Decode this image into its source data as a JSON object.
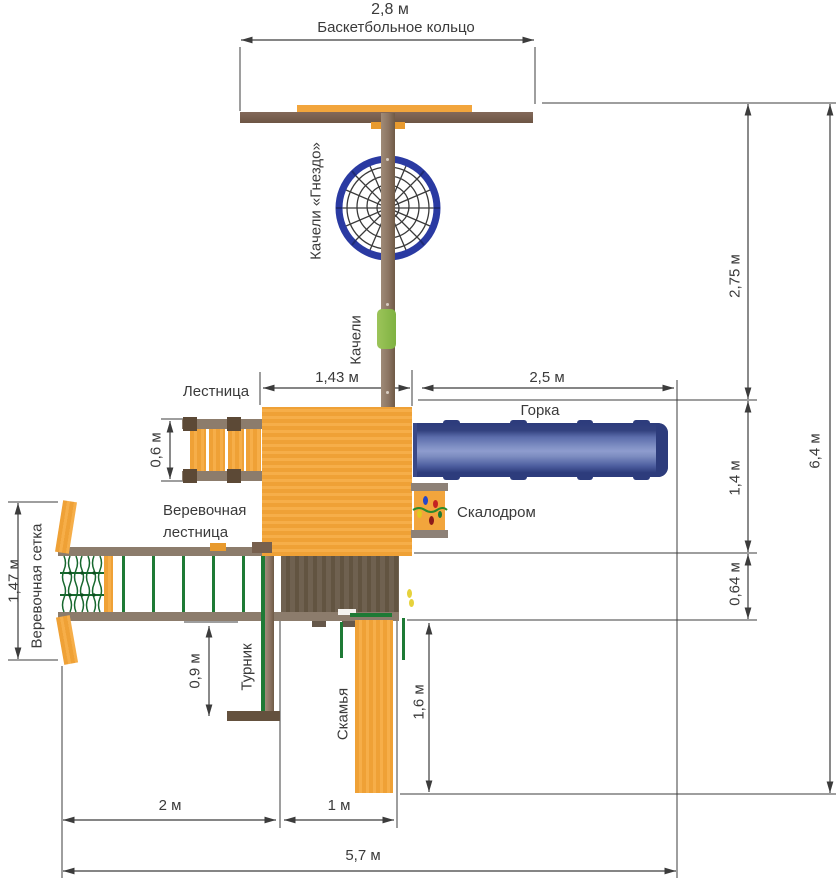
{
  "diagram": {
    "title": "Схема детской игровой площадки (вид сверху)",
    "labels": {
      "basketball_hoop": "Баскетбольное кольцо",
      "nest_swing": "Качели «Гнездо»",
      "swing": "Качели",
      "ladder": "Лестница",
      "slide": "Горка",
      "rope_ladder_line1": "Веревочная",
      "rope_ladder_line2": "лестница",
      "climbing_wall": "Скалодром",
      "rope_net": "Веревочная сетка",
      "pullup_bar": "Турник",
      "bench": "Скамья"
    },
    "dimensions": {
      "top_width": "2,8 м",
      "platform_width": "1,43 м",
      "slide_length": "2,5 м",
      "ladder_width": "0,6 м",
      "upper_height": "2,75 м",
      "total_height": "6,4 м",
      "slide_zone": "1,4 м",
      "wall_zone": "0,64 м",
      "net_height": "1,47 м",
      "bar_offset": "0,9 м",
      "bench_length": "1,6 м",
      "left_span": "2 м",
      "mid_span": "1 м",
      "total_width": "5,7 м"
    },
    "colors": {
      "wood_orange": "#f2a53c",
      "beam_brown": "#77604e",
      "rail_gray_brown": "#8c7c6c",
      "dark_wood": "#665743",
      "slide_blue": "#5b6cab",
      "slide_blue_dark": "#2d3c7c",
      "nest_ring_blue": "#2a3aa2",
      "rope_green": "#1e7a35",
      "seat_green": "#85b544",
      "dimension_line": "#3c3c3c"
    }
  }
}
